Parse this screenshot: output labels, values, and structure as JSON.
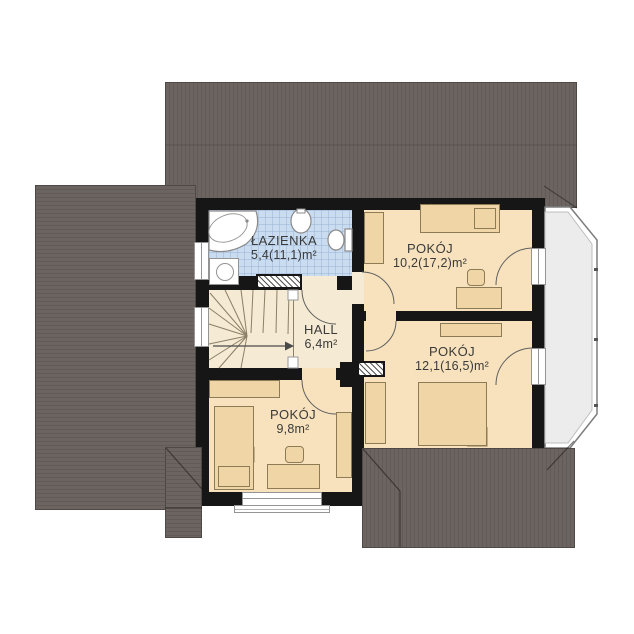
{
  "plan_title": "floor-plan-upper-storey",
  "rooms": [
    {
      "id": "lazienka",
      "name": "ŁAZIENKA",
      "area": "5,4(11,1)m²"
    },
    {
      "id": "pokoj-top-right",
      "name": "POKÓJ",
      "area": "10,2(17,2)m²"
    },
    {
      "id": "hall",
      "name": "HALL",
      "area": "6,4m²"
    },
    {
      "id": "pokoj-bottom-right",
      "name": "POKÓJ",
      "area": "12,1(16,5)m²"
    },
    {
      "id": "pokoj-bottom-left",
      "name": "POKÓJ",
      "area": "9,8m²"
    }
  ],
  "fixtures": [
    "corner-bathtub",
    "washbasin",
    "toilet",
    "washing-machine",
    "winder-stairs",
    "beds",
    "desks",
    "chairs",
    "wardrobes",
    "radiators",
    "balcony"
  ],
  "colors": {
    "roof": "#6B6460",
    "walls": "#161616",
    "room_floor": "#F7E2BD",
    "hall_floor": "#F5EAD3",
    "bathroom_floor": "#C9DCF0",
    "furniture": "#F0D6A6",
    "balcony": "#ECECEC",
    "text": "#3A3A3A"
  }
}
